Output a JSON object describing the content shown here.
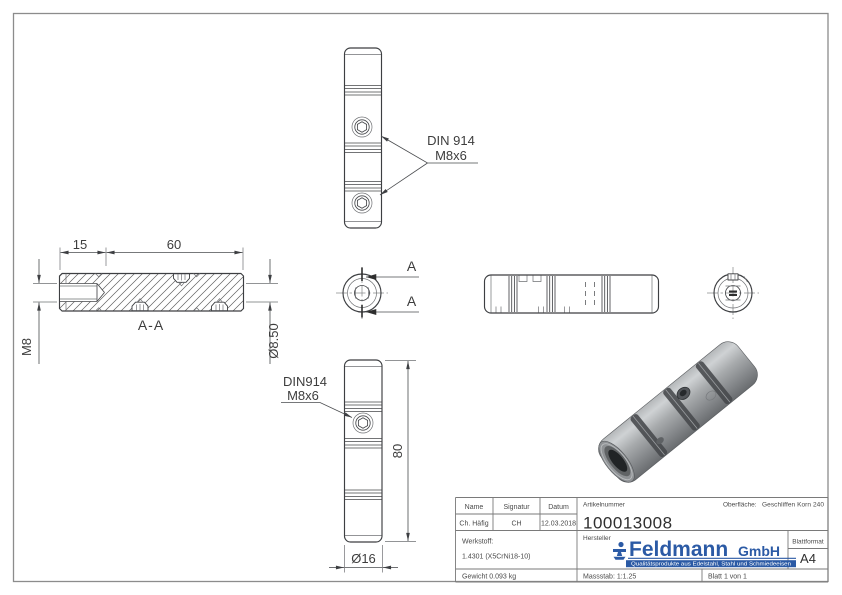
{
  "colors": {
    "background": "#ffffff",
    "frame": "#8c8c8c",
    "line": "#3d3f42",
    "logo_blue": "#2b5aa5"
  },
  "callouts": {
    "top": {
      "line1": "DIN 914",
      "line2": "M8x6"
    },
    "bottom": {
      "line1": "DIN914",
      "line2": "M8x6"
    }
  },
  "section": {
    "label": "A-A",
    "arrow_label": "A"
  },
  "dimensions": {
    "counterbore_depth": "15",
    "body_length": "60",
    "thread": "M8",
    "bore_diameter": "Ø8.50",
    "total_length": "80",
    "outer_diameter": "Ø16"
  },
  "title_block": {
    "name_label": "Name",
    "name_value": "Ch. Häfig",
    "signature_label": "Signatur",
    "signature_value": "CH",
    "date_label": "Datum",
    "date_value": "12.03.2018",
    "article_label": "Artikelnummer",
    "article_value": "100013008",
    "surface_label": "Oberfläche:",
    "surface_value": "Geschliffen Korn 240",
    "material_label": "Werkstoff:",
    "material_value": "1.4301 (X5CrNi18-10)",
    "manufacturer_label": "Hersteller",
    "logo_name": "Feldmann",
    "logo_suffix": "GmbH",
    "logo_tagline": "Qualitätsprodukte aus Edelstahl, Stahl und Schmiedeeisen",
    "format_label": "Blattformat",
    "format_value": "A4",
    "weight": "Gewicht 0.093 kg",
    "scale": "Massstab: 1:1.25",
    "sheet": "Blatt 1 von 1"
  }
}
